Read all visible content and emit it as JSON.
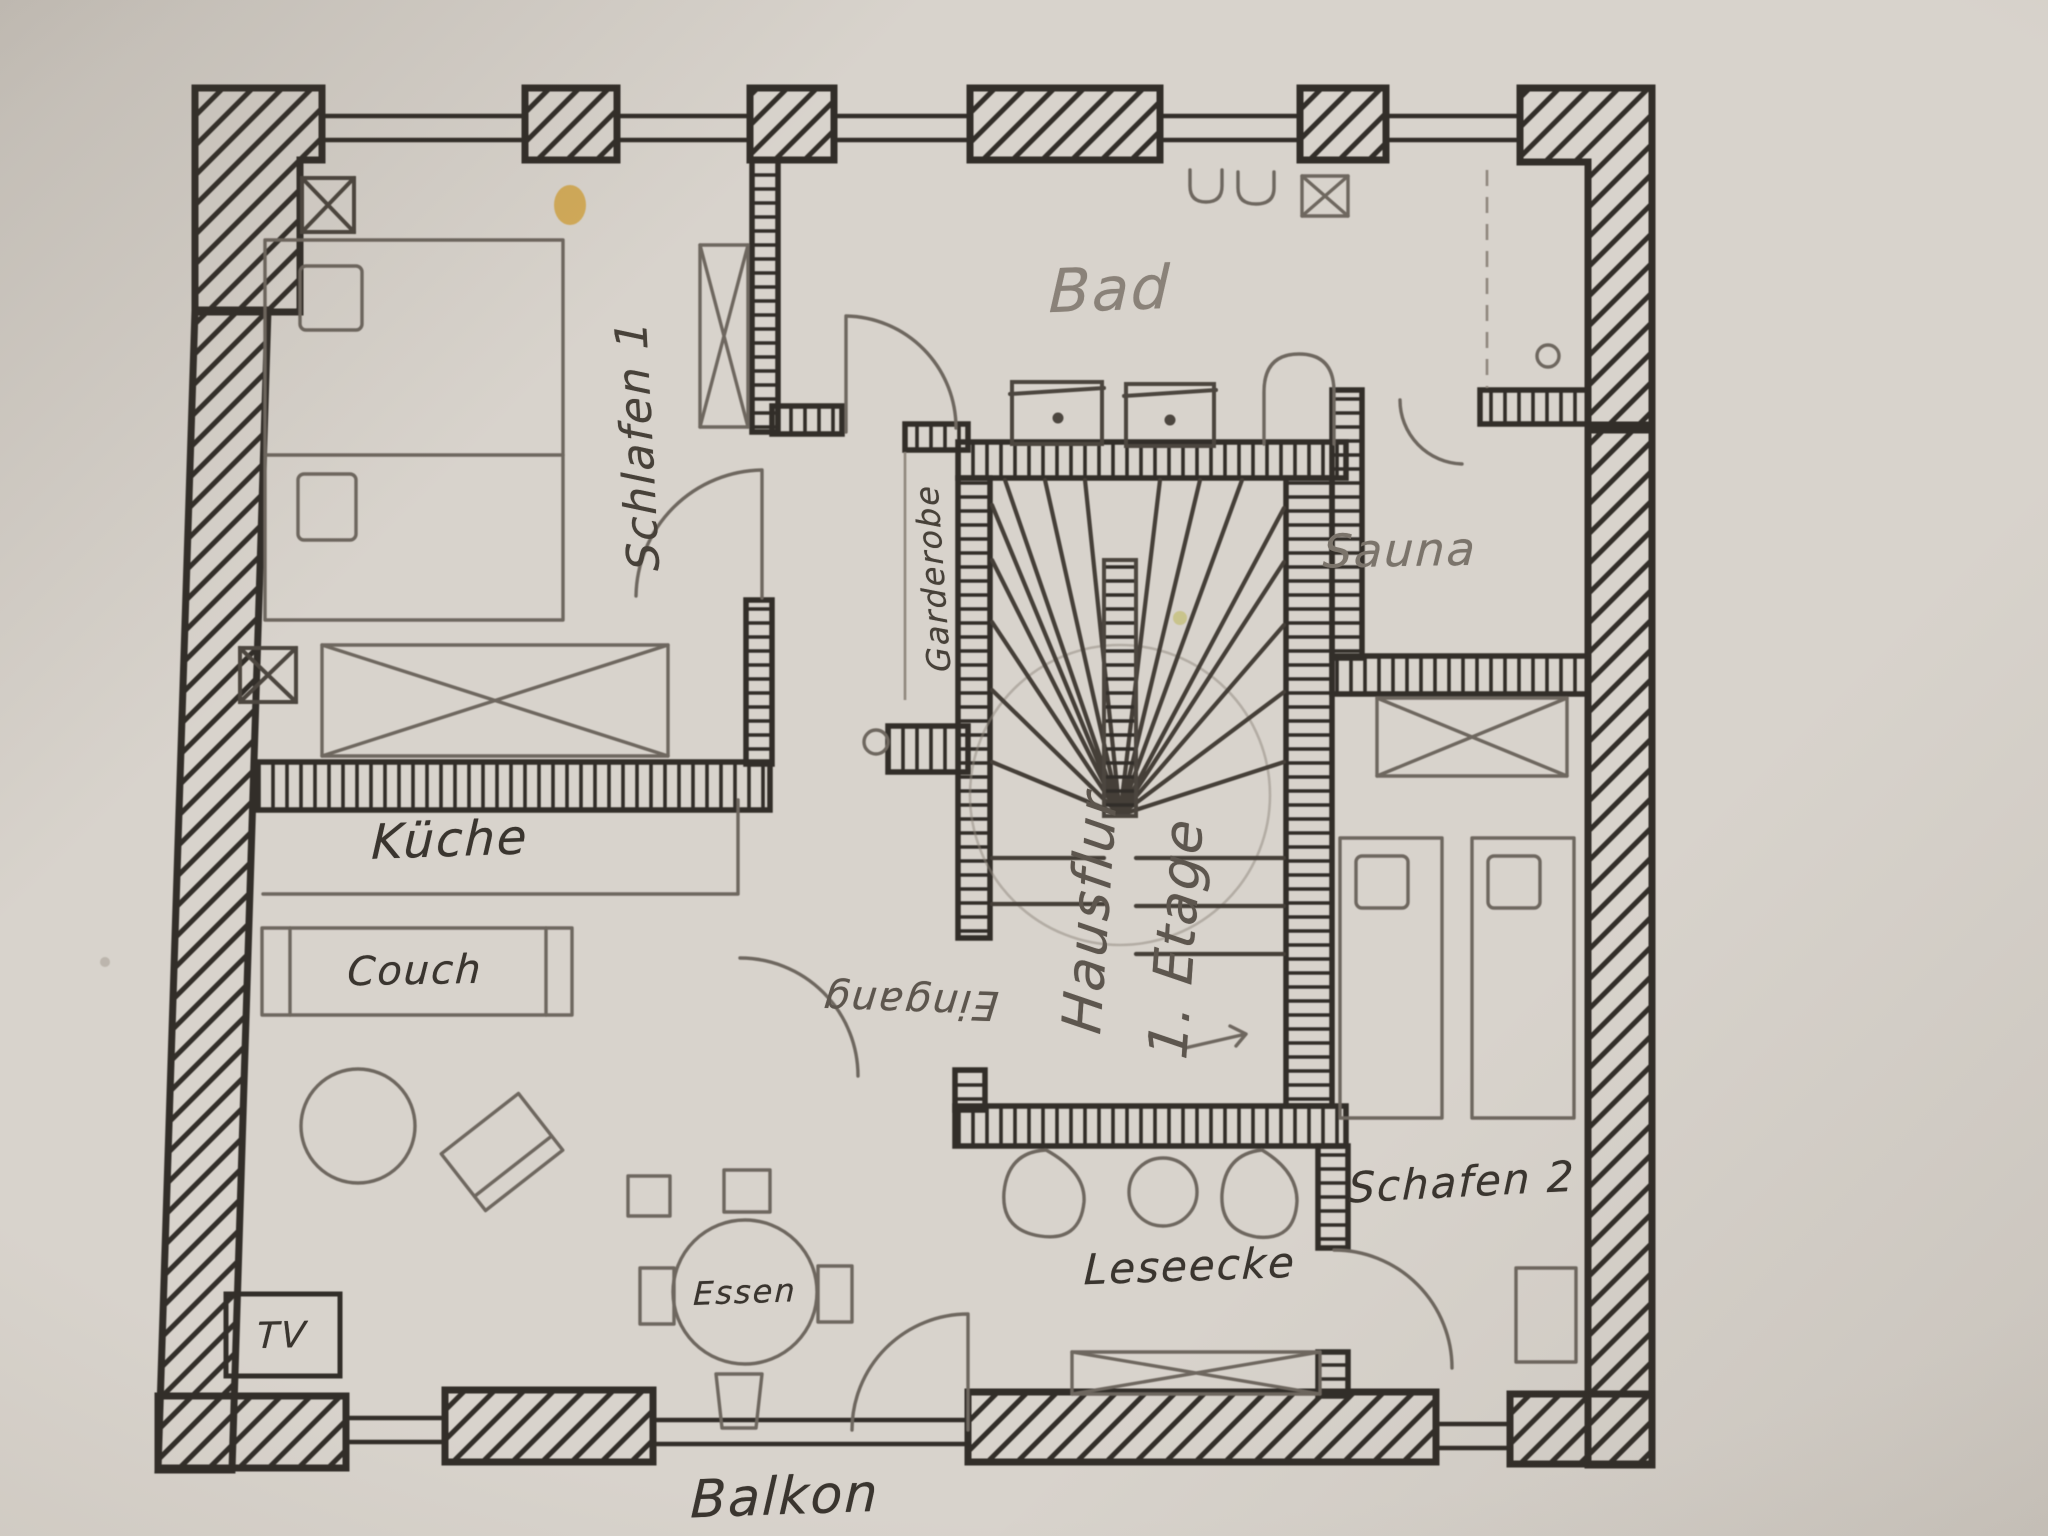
{
  "meta": {
    "description": "Hand-drawn apartment floor plan sketch (photo of paper)",
    "floor_note": "1. Etage"
  },
  "colors": {
    "paper": "#d8d3cc",
    "paper_edge": "#a59e94",
    "ink": "#322e29",
    "pencil": "#6e675f",
    "pencil_light": "#8f877d",
    "stain": "#d0a03c"
  },
  "labels": {
    "schlafen1": "Schlafen 1",
    "bad": "Bad",
    "sauna": "Sauna",
    "garderobe": "Garderobe",
    "hausflur_line1": "Hausflur",
    "hausflur_line2": "1. Etage",
    "eingang": "Eingang",
    "kueche": "Küche",
    "couch": "Couch",
    "essen": "Essen",
    "tv": "TV",
    "leseecke": "Leseecke",
    "schlafen2": "Schafen 2",
    "balkon": "Balkon"
  }
}
